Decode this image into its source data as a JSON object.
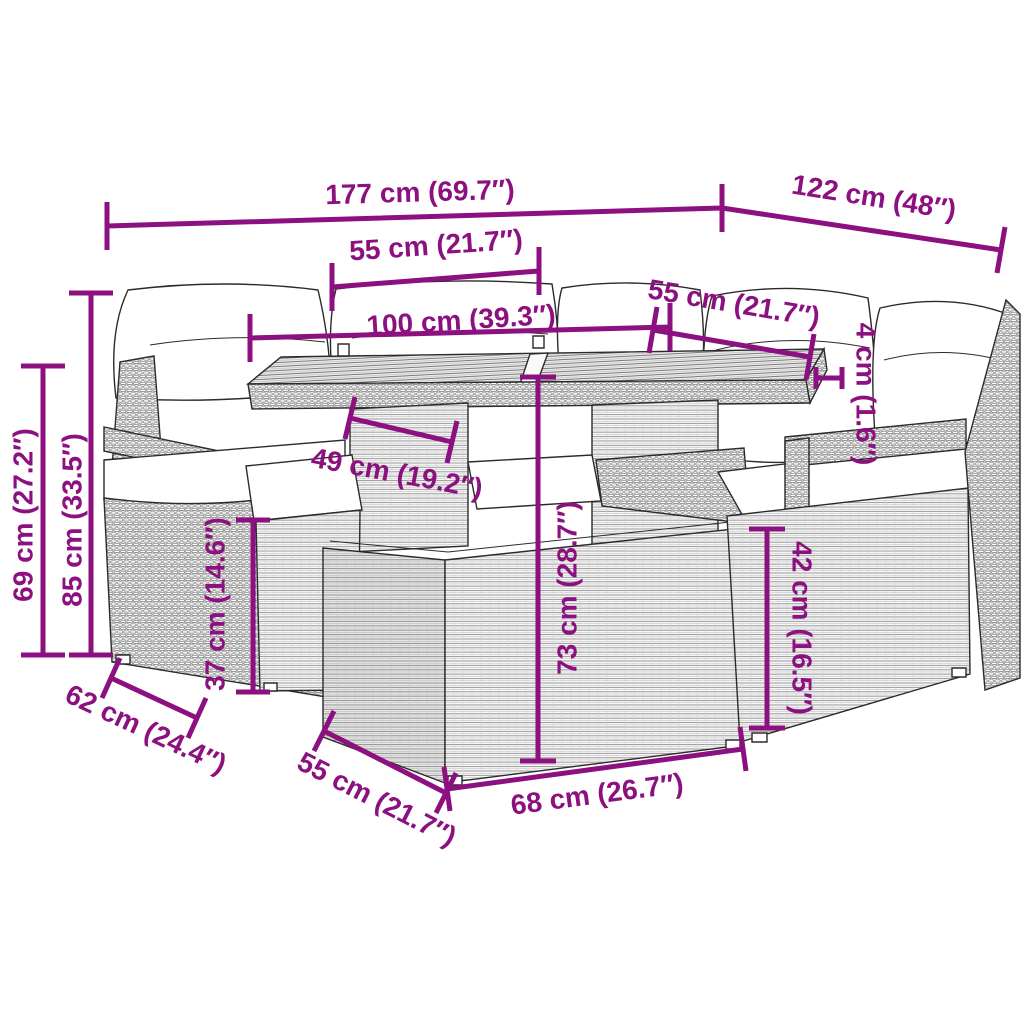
{
  "diagram": {
    "title": "Garden lounge furniture set with cushions — dimension diagram",
    "style": "technical line drawing, poly rattan weave",
    "colors": {
      "dimension_annotation": "#8C107F",
      "drawing_outline": "#2b2b2b",
      "background": "#ffffff",
      "cushions": "#ffffff"
    },
    "dimensions": [
      {
        "id": "set-width",
        "label": "177 cm (69.7″)"
      },
      {
        "id": "set-depth",
        "label": "122 cm (48″)"
      },
      {
        "id": "sofa-seat-width",
        "label": "55 cm (21.7″)"
      },
      {
        "id": "table-top-length",
        "label": "100 cm (39.3″)"
      },
      {
        "id": "chair-seat-width",
        "label": "55 cm (21.7″)"
      },
      {
        "id": "cushion-thickness",
        "label": "4 cm (1.6″)"
      },
      {
        "id": "backrest-height",
        "label": "85 cm (33.5″)"
      },
      {
        "id": "armrest-height",
        "label": "69 cm (27.2″)"
      },
      {
        "id": "stool-height",
        "label": "37 cm (14.6″)"
      },
      {
        "id": "table-base-width",
        "label": "49 cm (19.2″)"
      },
      {
        "id": "table-height",
        "label": "73 cm (28.7″)"
      },
      {
        "id": "seat-frame-height",
        "label": "42 cm (16.5″)"
      },
      {
        "id": "sofa-depth",
        "label": "62 cm (24.4″)"
      },
      {
        "id": "stool-depth",
        "label": "55 cm (21.7″)"
      },
      {
        "id": "stool-width",
        "label": "68 cm (26.7″)"
      }
    ]
  }
}
